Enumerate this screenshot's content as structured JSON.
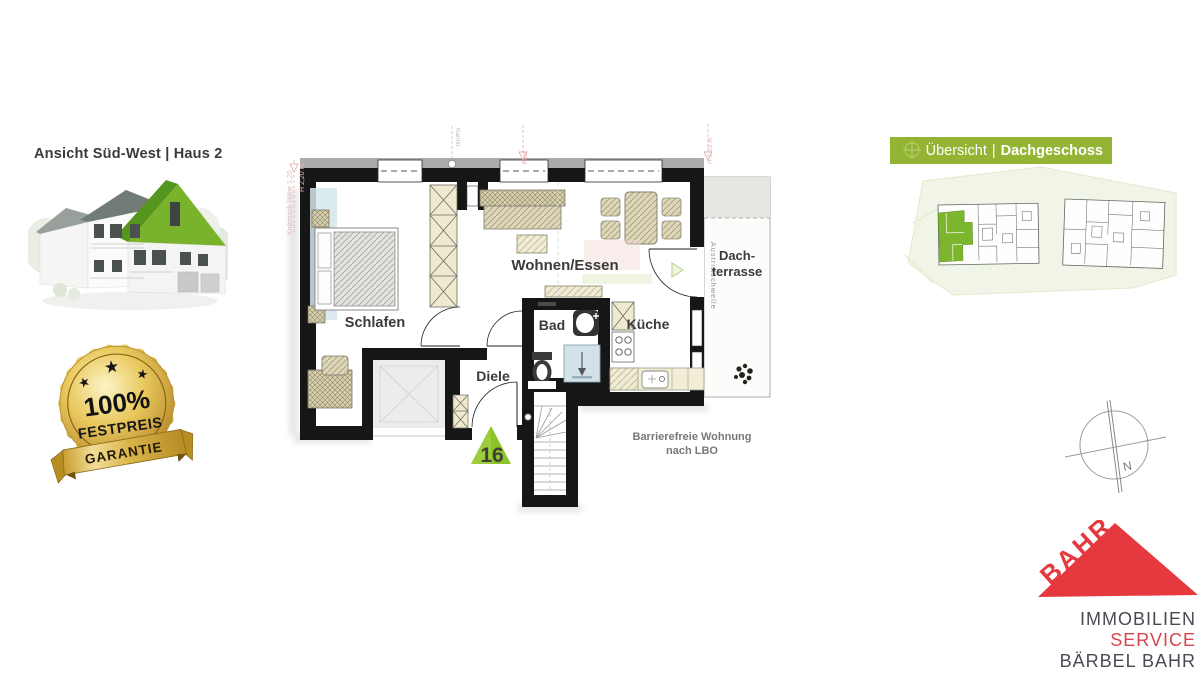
{
  "header_left": {
    "title": "Ansicht Süd-West | Haus 2"
  },
  "badge": {
    "percent": "100%",
    "word": "FESTPREIS",
    "ribbon": "GARANTIE"
  },
  "floorplan": {
    "rooms": {
      "bedroom": "Schlafen",
      "living": "Wohnen/Essen",
      "bath": "Bad",
      "hall": "Diele",
      "kitchen": "Küche",
      "terrace_line1": "Dach-",
      "terrace_line2": "terrasse"
    },
    "unit_number": "16",
    "note_line1": "Barrierefreie Wohnung",
    "note_line2": "nach LBO",
    "annotations": {
      "threshold": "Austrittschwelle",
      "chimney": "Kamin",
      "ridge": "First",
      "height_left": "H 2,20 m",
      "height_right": "H 2,20 m",
      "knee_wall": "Kniestock Höhe 1,20"
    }
  },
  "overview_banner": {
    "regular": "Übersicht",
    "separator": "|",
    "bold": "Dachgeschoss"
  },
  "compass": {
    "north": "N"
  },
  "logo": {
    "roof": "BAHR",
    "line1": "IMMOBILIEN",
    "line2": "SERVICE",
    "line3": "BÄRBEL BAHR"
  },
  "colors": {
    "accent_green": "#8cc22c",
    "banner_green": "#94b434",
    "logo_red": "#e6393f",
    "gold": "#d9b33c",
    "wall": "#161616",
    "shower_blue": "#d3e2e9",
    "hatch_cream": "#efe9d0",
    "note_gray": "#787878"
  }
}
